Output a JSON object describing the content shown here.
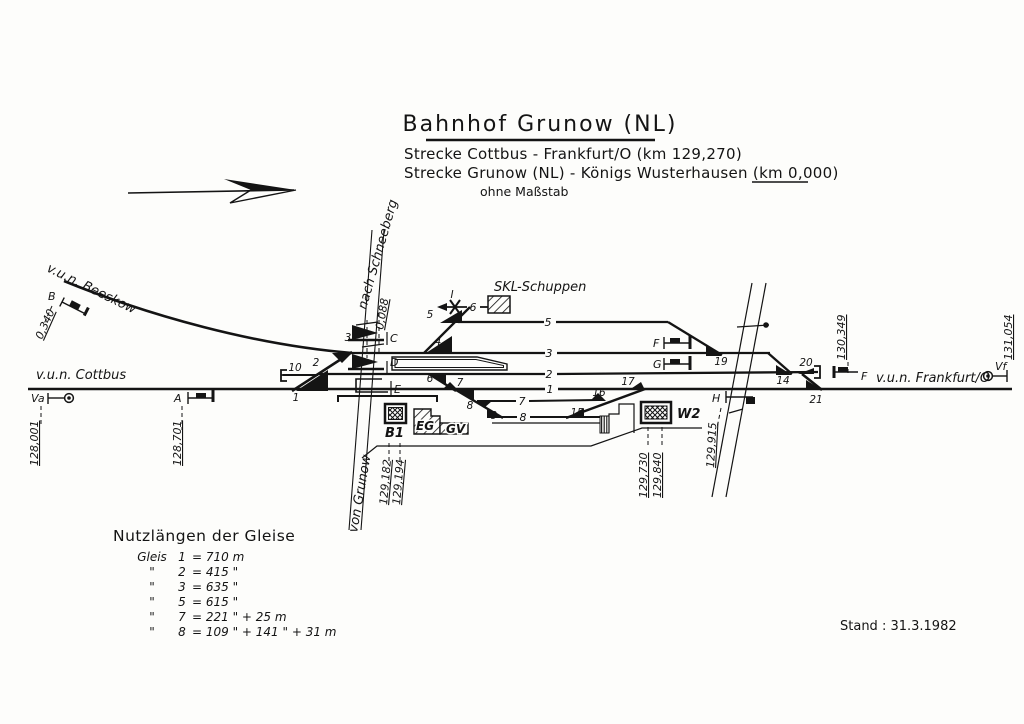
{
  "header": {
    "title": "Bahnhof Grunow (NL)",
    "route1": "Strecke Cottbus - Frankfurt/O (km 129,270)",
    "route2": "Strecke Grunow (NL) - Königs Wusterhausen (km 0,000)",
    "scale_note": "ohne Maßstab"
  },
  "directions": {
    "beeskow": "v.u.n. Beeskow",
    "cottbus": "v.u.n. Cottbus",
    "frankfurt": "v.u.n. Frankfurt/O"
  },
  "branch": {
    "km": "0,088",
    "to": "nach Schneeberg",
    "from": "von Grunow"
  },
  "signals": {
    "b": {
      "label": "B",
      "km": "0,340"
    },
    "va": {
      "label": "Va",
      "km": "128,001"
    },
    "a": {
      "label": "A",
      "km": "128,701"
    },
    "c": {
      "label": "C"
    },
    "d": {
      "label": "D"
    },
    "e": {
      "label": "E"
    },
    "f_mid": {
      "label": "F"
    },
    "g": {
      "label": "G"
    },
    "h": {
      "label": "H",
      "km": "129,915"
    },
    "f_east": {
      "label": "F",
      "km": "130,349"
    },
    "vf": {
      "label": "Vf",
      "km": "131,054"
    }
  },
  "posts": {
    "b1": {
      "label": "B1",
      "km1": "129,182",
      "km2": "129,194"
    },
    "w2": {
      "label": "W2",
      "km1": "129,730",
      "km2": "129,840"
    }
  },
  "buildings": {
    "skl": "SKL-Schuppen",
    "eg": "EG",
    "gv": "GV"
  },
  "track_labels": {
    "t1": "1",
    "t2": "2",
    "t3": "3",
    "t5": "5",
    "t6": "6",
    "t7": "7",
    "t8": "8"
  },
  "derail_label": "I",
  "points": [
    {
      "n": "1"
    },
    {
      "n": "2"
    },
    {
      "n": "3"
    },
    {
      "n": "4"
    },
    {
      "n": "5"
    },
    {
      "n": "6"
    },
    {
      "n": "7"
    },
    {
      "n": "8"
    },
    {
      "n": "9"
    },
    {
      "n": "10"
    },
    {
      "n": "14"
    },
    {
      "n": "15"
    },
    {
      "n": "16"
    },
    {
      "n": "17"
    },
    {
      "n": "19"
    },
    {
      "n": "20"
    },
    {
      "n": "21"
    }
  ],
  "nutzlaengen": {
    "title": "Nutzlängen der Gleise",
    "rows": [
      {
        "c1": "Gleis",
        "c2": "1",
        "c3": "= 710 m"
      },
      {
        "c1": "\"",
        "c2": "2",
        "c3": "= 415 \""
      },
      {
        "c1": "\"",
        "c2": "3",
        "c3": "= 635 \""
      },
      {
        "c1": "\"",
        "c2": "5",
        "c3": "= 615 \""
      },
      {
        "c1": "\"",
        "c2": "7",
        "c3": "= 221 \"  + 25 m"
      },
      {
        "c1": "\"",
        "c2": "8",
        "c3": "= 109 \"  + 141 \"  + 31 m"
      }
    ]
  },
  "footer": {
    "stand": "Stand : 31.3.1982"
  }
}
